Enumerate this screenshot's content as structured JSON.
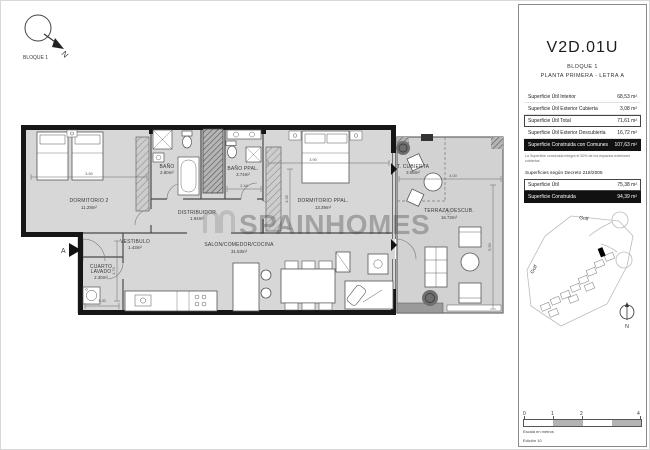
{
  "north": "N",
  "compass": {
    "label": "BLOQUE 1"
  },
  "watermark": {
    "text": "SPAINHOMES",
    "reg": "®"
  },
  "plan": {
    "entrance_label": "A",
    "rooms": [
      {
        "name": "DORMITORIO 2",
        "area": "11.28m²"
      },
      {
        "name": "BAÑO",
        "area": "2.80m²"
      },
      {
        "name": "BAÑO PPAL.",
        "area": "3.74m²"
      },
      {
        "name": "DISTRIBUIDOR",
        "area": "1.94m²"
      },
      {
        "name": "DORMITORIO PPAL.",
        "area": "13.39m²"
      },
      {
        "name": "T. CUBIERTA",
        "area": "3.08m²"
      },
      {
        "name": "TERRAZA DESCUB.",
        "area": "16.72m²"
      },
      {
        "name": "VESTIBULO",
        "area": "1.43m²"
      },
      {
        "name_line1": "CUARTO",
        "name_line2": "LAVADO",
        "area": "2.30m²"
      },
      {
        "name": "SALON/COMEDOR/COCINA",
        "area": "31.53m²"
      }
    ],
    "dimensions": [
      "3.50",
      "3.90",
      "2.44",
      "4.00",
      "5.50",
      "1.30",
      "3.35",
      "1.70"
    ]
  },
  "panel": {
    "unit_code": "V2D.01U",
    "block": "BLOQUE 1",
    "floor": "PLANTA PRIMERA - LETRA A",
    "surfaces": [
      {
        "label": "Superficie Útil Interior",
        "value": "68,53 m²"
      },
      {
        "label": "Superficie Útil Exterior Cubierta",
        "value": "3,08 m²"
      },
      {
        "label": "Superficie Útil Total",
        "value": "71,61 m²"
      },
      {
        "label": "Superficie Útil Exterior Descubierta",
        "value": "16,72 m²"
      },
      {
        "label": "Superficie Construida con Comunes",
        "value": "107,63 m²"
      }
    ],
    "footnote": "La Superficie construida integra el 50% de los espacios exteriores cubiertos",
    "decree": {
      "title": "Superficies según Decreto 218/2005",
      "rows": [
        {
          "label": "Superficie Útil",
          "value": "75,38 m²"
        },
        {
          "label": "Superficie Construida",
          "value": "94,39 m²"
        }
      ]
    },
    "siteplan": {
      "golf_top": "Golf",
      "golf_left": "Golf"
    },
    "scalebar": {
      "ticks": [
        "0",
        "1",
        "2",
        "4"
      ],
      "caption": "Escala en metros",
      "edition": "Edición 10"
    }
  }
}
